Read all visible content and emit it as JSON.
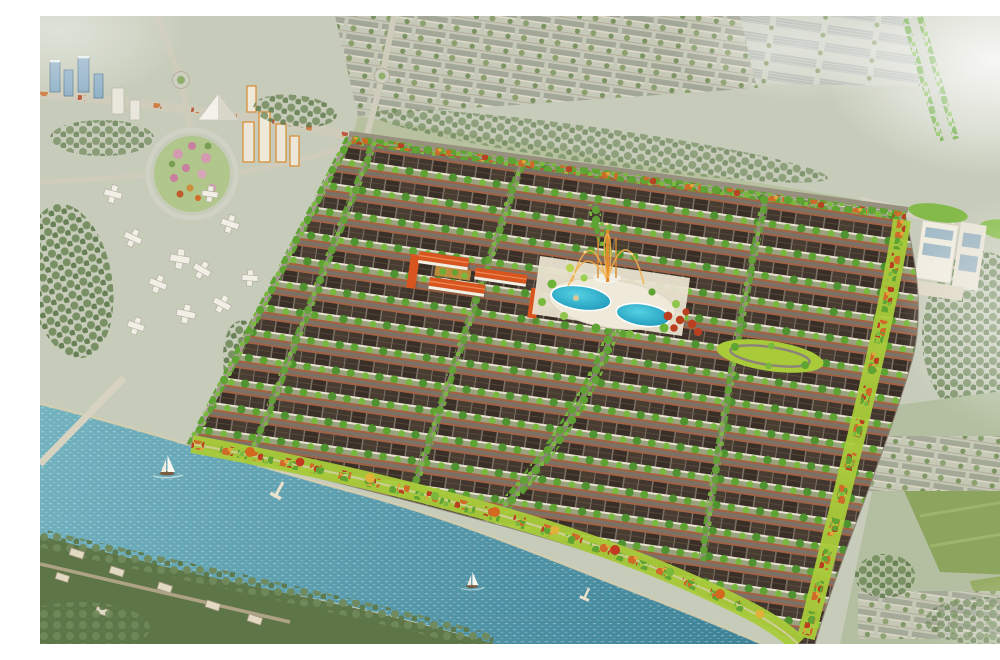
{
  "meta": {
    "title": "Aerial perspective rendering of a riverside residential master-planned development",
    "type": "architectural-rendering"
  },
  "palette": {
    "city_ground": "#c7ccba",
    "river_light": "#73b2bf",
    "river_deep": "#3a7f95",
    "pool_light": "#55d2e4",
    "pool_deep": "#1a93b6",
    "grass_bright": "#a9cb3a",
    "tree_green": "#5fa332",
    "tree_orange": "#cf6a28",
    "tree_red": "#b93f20",
    "muted_tree": "#70895a",
    "roof_dark": "#42372e",
    "facade": "#e9e3d2",
    "street": "#7b7166",
    "sidewalk": "#ad5f39",
    "school_roof": "#d9551f",
    "tower_blue": "#92b2c8",
    "tower_orange": "#d98a30",
    "haze": "#ffffff"
  },
  "scene": {
    "sailboats": 2,
    "piers": 2,
    "swimming_pools": 2,
    "school_buildings": 5,
    "features": [
      "river",
      "riverside-promenade",
      "housing-grid",
      "central-boulevard",
      "swimming-pool-complex",
      "fountain",
      "school-campus",
      "oval-park",
      "flower-park",
      "high-rise-cluster",
      "warehouse-district",
      "tree-lined-avenue",
      "shopping-mall",
      "village-outskirts"
    ]
  }
}
